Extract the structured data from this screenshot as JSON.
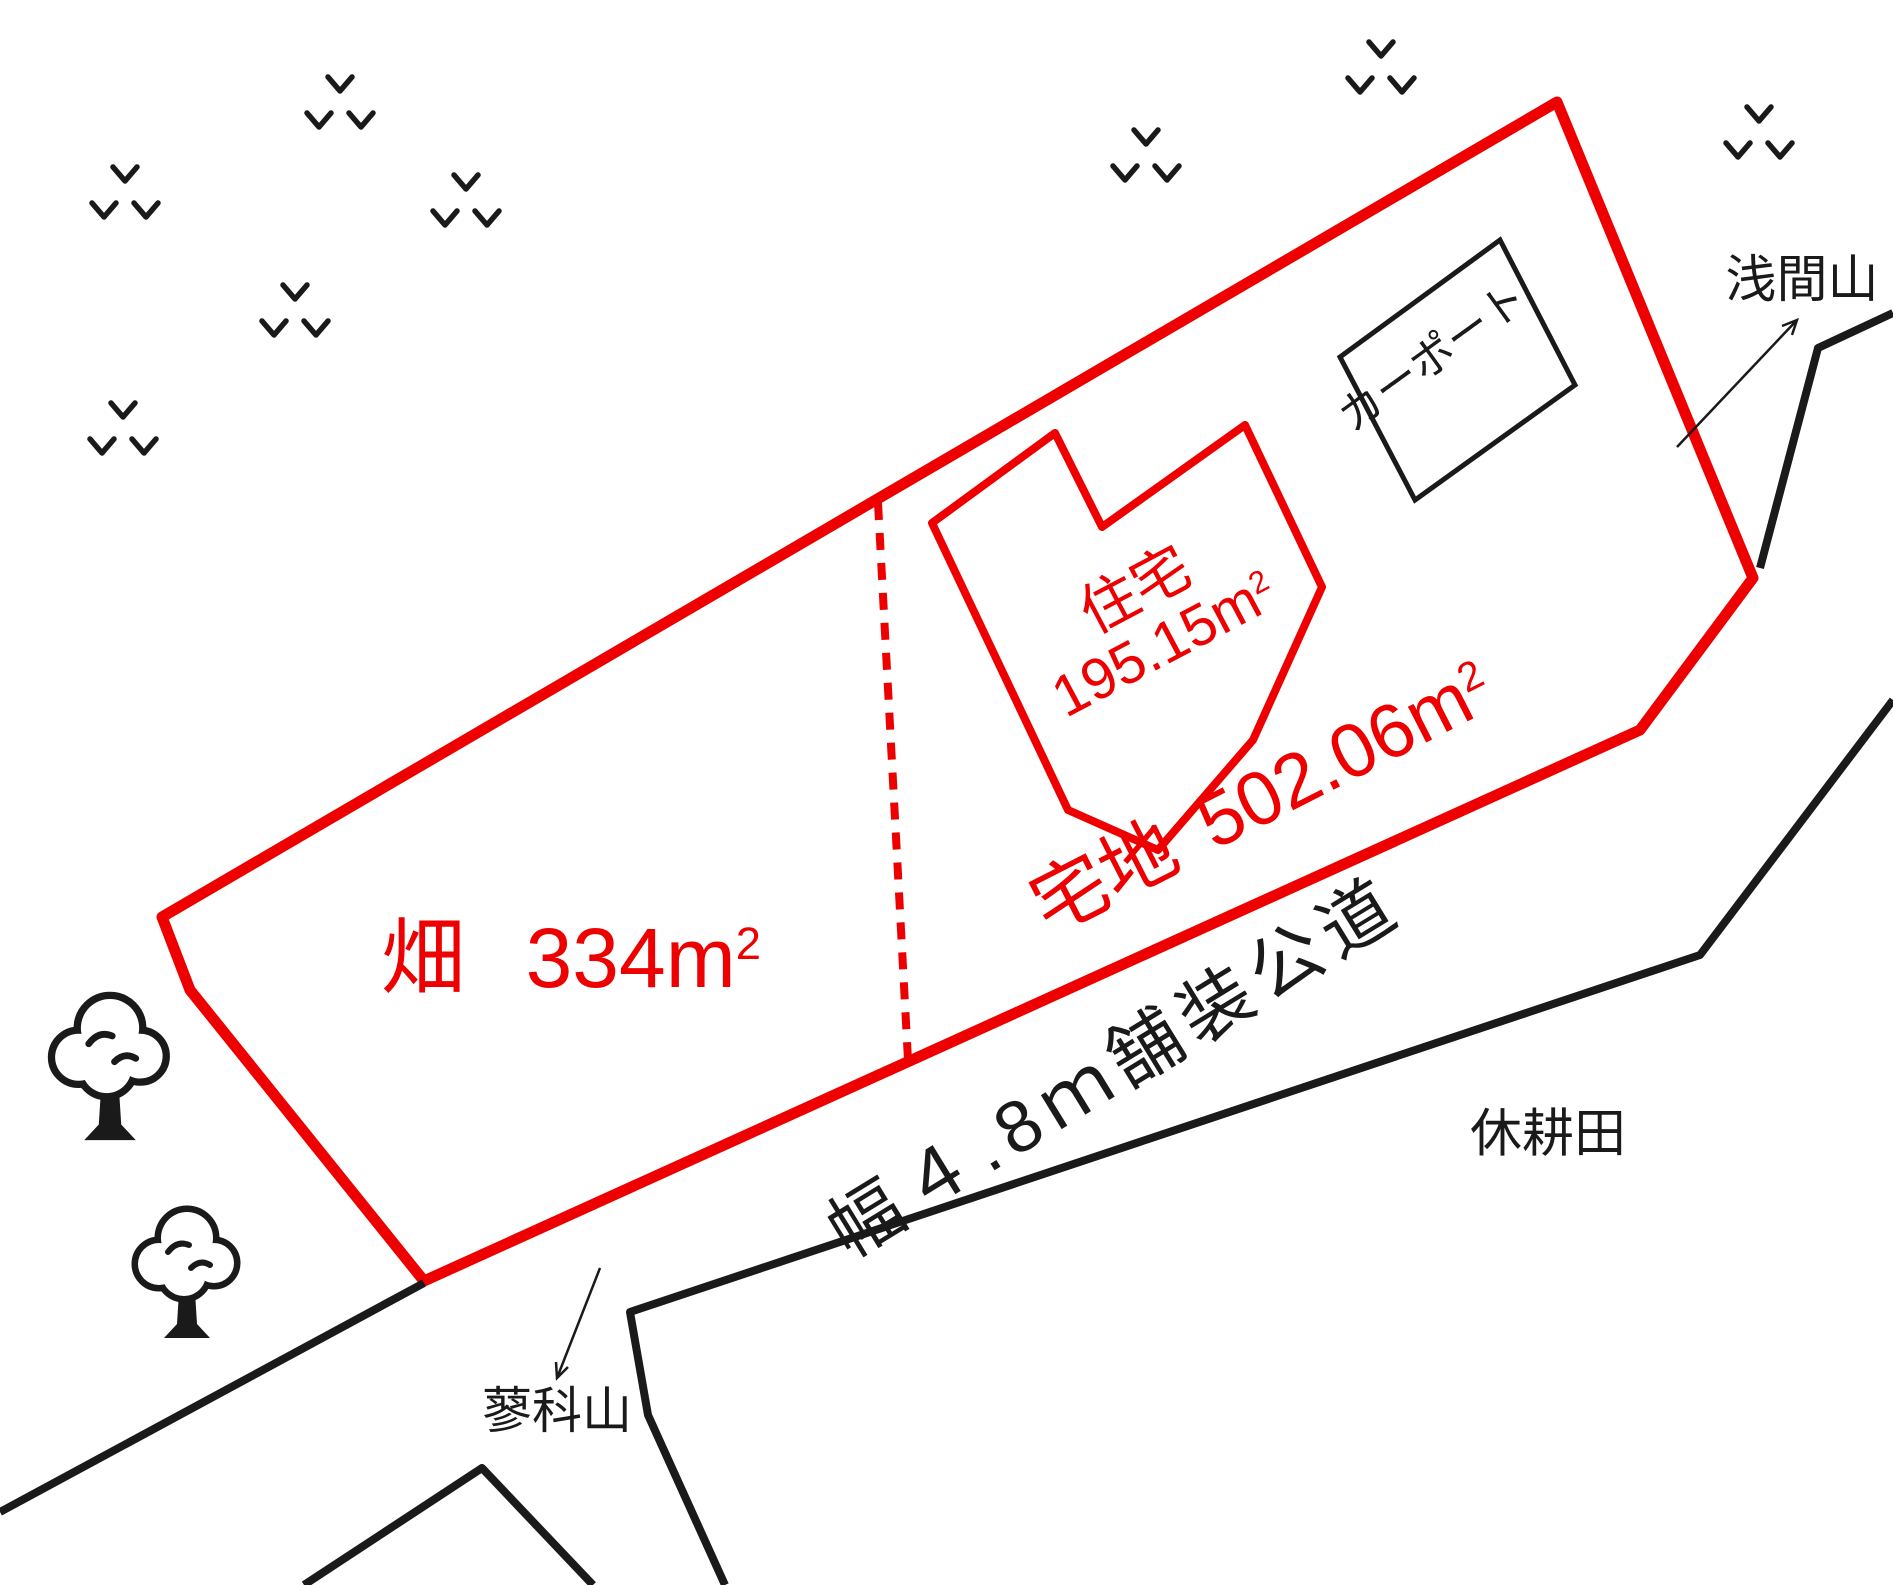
{
  "colors": {
    "accent_red": "#ee0000",
    "line_black": "#1a1a1a"
  },
  "labels": {
    "field": {
      "name": "畑",
      "area": "334m",
      "sup": "2"
    },
    "plot": {
      "name": "宅地",
      "area": "502.06m",
      "sup": "2"
    },
    "house": {
      "name": "住宅",
      "area": "195.15m",
      "sup": "2"
    },
    "carport": "カーポート",
    "road": "幅４.8ｍ舗装公道",
    "mt_asama": "浅間山",
    "mt_tateshina": "蓼科山",
    "fallow_field": "休耕田"
  }
}
